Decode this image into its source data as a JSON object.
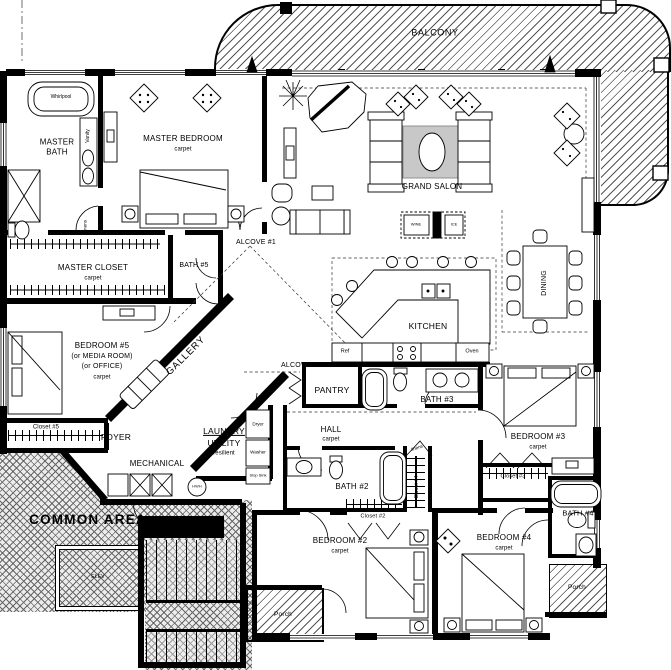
{
  "rooms": {
    "balcony": "BALCONY",
    "masterBath": "MASTER BATH",
    "masterBedroom": "MASTER BEDROOM",
    "grandSalon": "GRAND SALON",
    "masterCloset": "MASTER CLOSET",
    "bath5": "BATH #5",
    "alcove1": "ALCOVE #1",
    "bedroom5": "BEDROOM #5",
    "bedroom5Alt1": "(or MEDIA ROOM)",
    "bedroom5Alt2": "(or OFFICE)",
    "gallery": "GALLERY",
    "closet5": "Closet #5",
    "foyer": "FOYER",
    "laundry": "LAUNDRY",
    "utility": "UTILITY",
    "mechanical": "MECHANICAL",
    "commonArea": "COMMON AREA",
    "elevator": "ELEV",
    "alcove2": "ALCOVE #2",
    "pantry": "PANTRY",
    "kitchen": "KITCHEN",
    "dining": "DINING",
    "bath3": "BATH #3",
    "hall": "HALL",
    "bath2": "BATH #2",
    "closet2": "Closet #2",
    "closet4": "Closet #4",
    "bedroom2": "BEDROOM #2",
    "porchLeft": "Porch",
    "bedroom3": "BEDROOM #3",
    "closet3": "Closet #3",
    "bath4": "BATH #4",
    "bedroom4": "BEDROOM #4",
    "porchRight": "Porch"
  },
  "finishes": {
    "carpet": "carpet",
    "resilient": "resilient"
  },
  "fixtures": {
    "whirlpool": "Whirlpool",
    "vanity": "Vanity",
    "linens": "linens",
    "dryer": "Dryer",
    "washer": "Washer",
    "slopSink": "Slop Sink",
    "hwh": "HWH",
    "ref": "Ref",
    "oven": "Oven",
    "wine": "WINE",
    "ice": "ICE"
  },
  "colors": {
    "ink": "#000000",
    "rug": "#c8c8c8",
    "hatchLine": "#555555"
  }
}
